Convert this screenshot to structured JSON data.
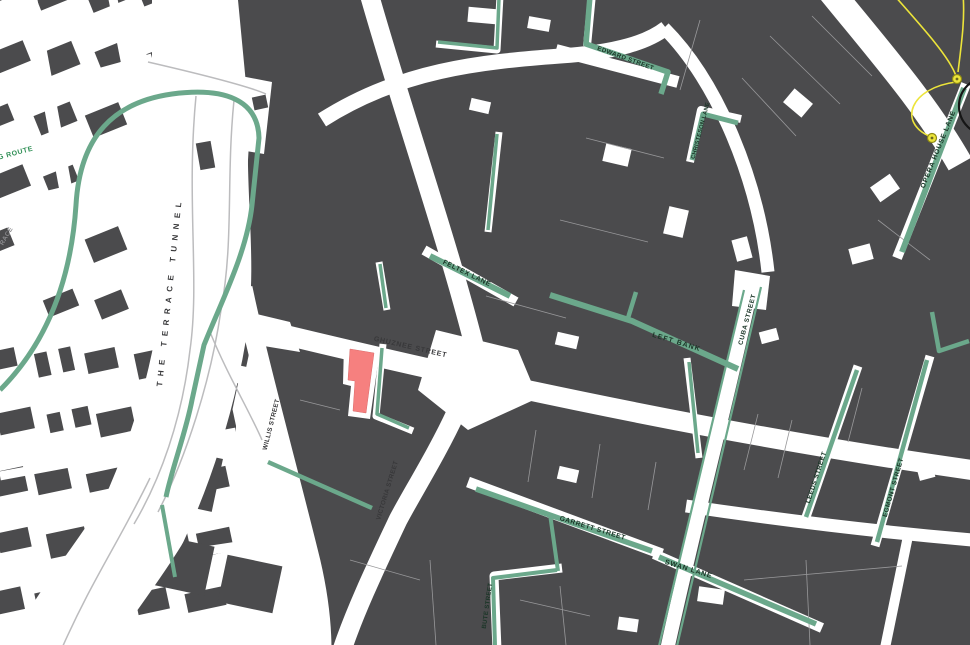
{
  "canvas": {
    "width": 970,
    "height": 645
  },
  "colors": {
    "background": "#ffffff",
    "building": "#4b4b4d",
    "parcel_line": "#98989a",
    "laneway_green": "#6ba88b",
    "label_lane": "#1b3527",
    "label_street": "#38383a",
    "label_route_green": "#2f8f55",
    "label_muted": "#8b8b8e",
    "highlight_red": "#f6807f",
    "annotation_yellow": "#ece43a",
    "annotation_black": "#161616",
    "ramp_gray": "#bcbcbe"
  },
  "labels": [
    {
      "text": "GHUZNEE STREET",
      "x": 410,
      "y": 349,
      "rot": 13,
      "cls": "street",
      "size": 7,
      "ls": 0.8
    },
    {
      "text": "WILLIS STREET",
      "x": 273,
      "y": 425,
      "rot": -76,
      "cls": "street",
      "size": 6.4,
      "ls": 0.3
    },
    {
      "text": "VICTORIA STREET",
      "x": 389,
      "y": 491,
      "rot": -73,
      "cls": "street",
      "size": 6.4,
      "ls": 0.3
    },
    {
      "text": "THE TERRACE TUNNEL",
      "x": 172,
      "y": 292,
      "rot": -84,
      "cls": "street",
      "size": 8,
      "ls": 5.5
    },
    {
      "text": "EDWARD STREET",
      "x": 625,
      "y": 60,
      "rot": 20,
      "cls": "lane",
      "size": 6.3,
      "ls": 0.4
    },
    {
      "text": "CHRISTESON LANE",
      "x": 702,
      "y": 131,
      "rot": -75,
      "cls": "lane",
      "size": 5.8,
      "ls": 0.2
    },
    {
      "text": "OPERA HOUSE LANE",
      "x": 940,
      "y": 150,
      "rot": -68,
      "cls": "lane",
      "size": 6.8,
      "ls": 0.8
    },
    {
      "text": "FELTEX LANE",
      "x": 466,
      "y": 275,
      "rot": 26,
      "cls": "lane",
      "size": 6.8,
      "ls": 0.6
    },
    {
      "text": "LEFT BANK",
      "x": 676,
      "y": 344,
      "rot": 17,
      "cls": "lane",
      "size": 7,
      "ls": 1.2
    },
    {
      "text": "CUBA STREET",
      "x": 749,
      "y": 320,
      "rot": -75,
      "cls": "lane",
      "size": 6.5,
      "ls": 0.6
    },
    {
      "text": "GARRETT STREET",
      "x": 592,
      "y": 530,
      "rot": 17,
      "cls": "lane",
      "size": 6.8,
      "ls": 0.5
    },
    {
      "text": "SWAN LANE",
      "x": 688,
      "y": 571,
      "rot": 17,
      "cls": "lane",
      "size": 7,
      "ls": 0.8
    },
    {
      "text": "LEEDS STREET",
      "x": 818,
      "y": 478,
      "rot": -72,
      "cls": "lane",
      "size": 6.5,
      "ls": 0.4
    },
    {
      "text": "EGMONT STREET",
      "x": 895,
      "y": 488,
      "rot": -74,
      "cls": "lane",
      "size": 6.5,
      "ls": 0.4
    },
    {
      "text": "BUTE STREET",
      "x": 489,
      "y": 606,
      "rot": -82,
      "cls": "lane",
      "size": 6.2,
      "ls": 0.3
    },
    {
      "text": "G ROUTE",
      "x": 16,
      "y": 155,
      "rot": -15,
      "cls": "route",
      "size": 7,
      "ls": 0.6
    },
    {
      "text": "RACE",
      "x": 8,
      "y": 237,
      "rot": -60,
      "cls": "muted",
      "size": 6.5,
      "ls": 0.4
    }
  ],
  "green_segments": [
    {
      "d": "M 0,390 C 55,335 72,265 76,205 C 80,135 115,102 172,94 C 225,87 258,100 259,138 L 252,205 C 247,252 222,300 204,345 L 192,400 C 186,432 172,468 166,497",
      "w": 5
    },
    {
      "d": "M 590,-4 L 586,44 L 668,72 L 661,94",
      "w": 5.5
    },
    {
      "d": "M 738,123 L 703,114 L 692,160",
      "w": 5
    },
    {
      "d": "M 964,88 L 902,252",
      "w": 6
    },
    {
      "d": "M 550,295 L 632,321 L 738,369",
      "w": 6
    },
    {
      "d": "M 628,318 L 636,292",
      "w": 4.5
    },
    {
      "d": "M 744,290 L 659,646",
      "w": 2.2
    },
    {
      "d": "M 761,287 L 677,646",
      "w": 2.2
    },
    {
      "d": "M 476,489 L 652,551",
      "w": 5.5
    },
    {
      "d": "M 550,514 L 558,571",
      "w": 4
    },
    {
      "d": "M 659,557 L 816,624",
      "w": 5.5
    },
    {
      "d": "M 495,646 L 493,578 L 557,570",
      "w": 4
    },
    {
      "d": "M 857,370 L 806,517",
      "w": 4.5
    },
    {
      "d": "M 927,360 L 877,542",
      "w": 4.5
    },
    {
      "d": "M 497,134 L 488,230",
      "w": 3.5
    },
    {
      "d": "M 430,256 L 510,296",
      "w": 6
    },
    {
      "d": "M 380,264 L 386,308",
      "w": 3.5
    },
    {
      "d": "M 382,348 L 377,414 L 409,428",
      "w": 3.5
    },
    {
      "d": "M 268,462 L 372,508",
      "w": 4.5
    },
    {
      "d": "M 162,505 L 175,577",
      "w": 4
    },
    {
      "d": "M 969,341 L 939,351 L 932,312",
      "w": 4.5
    },
    {
      "d": "M 689,362 L 698,453",
      "w": 3.5
    },
    {
      "d": "M 499,-2 L 497,48 L 438,42",
      "w": 3.5
    }
  ],
  "streets_white": [
    {
      "d": "M 248,326 C 420,368 700,432 972,470",
      "w": 20
    },
    {
      "d": "M 368,-10 C 402,110 446,235 474,345 C 479,388 420,478 398,520 C 372,575 354,614 342,650",
      "w": 19
    },
    {
      "d": "M 243,288 C 258,360 291,480 311,562 C 318,592 322,622 322,650",
      "w": 19
    },
    {
      "d": "M 322,120 C 400,70 480,62 560,56 C 618,52 648,42 666,28",
      "w": 15
    },
    {
      "d": "M 556,50 L 678,82",
      "w": 12
    },
    {
      "d": "M 664,28 C 718,82 758,180 768,272",
      "w": 13
    },
    {
      "d": "M 828,-12 C 880,52 926,104 960,164",
      "w": 26
    },
    {
      "d": "M 753,280 C 730,390 700,500 667,650",
      "w": 14
    },
    {
      "d": "M 468,482 L 662,554",
      "w": 11
    },
    {
      "d": "M 654,554 L 822,628",
      "w": 10
    },
    {
      "d": "M 686,506 C 780,520 880,532 972,540",
      "w": 13
    },
    {
      "d": "M 858,366 L 805,520",
      "w": 9
    },
    {
      "d": "M 930,356 L 875,546",
      "w": 9
    },
    {
      "d": "M 497,650 L 494,576 L 562,568",
      "w": 9
    },
    {
      "d": "M 741,119 L 701,110 L 690,162",
      "w": 8
    },
    {
      "d": "M 592,-6 L 587,46",
      "w": 8
    },
    {
      "d": "M 499,132 L 488,232",
      "w": 7
    },
    {
      "d": "M 424,250 L 516,302",
      "w": 10
    },
    {
      "d": "M 379,262 L 387,310",
      "w": 7
    },
    {
      "d": "M 383,344 L 376,416 L 413,431",
      "w": 7
    },
    {
      "d": "M 687,358 L 699,458",
      "w": 7
    },
    {
      "d": "M 500,-4 L 497,50 L 436,44",
      "w": 7
    },
    {
      "d": "M 966,84 L 897,258",
      "w": 10
    },
    {
      "d": "M 908,536 L 885,648",
      "w": 10
    }
  ],
  "junction_polys": [
    "436,330 518,350 538,398 468,430 418,390",
    "240,310 290,322 300,352 252,344",
    "735,270 770,276 766,310 732,306",
    "138,56 272,82 264,154 146,134"
  ],
  "left_bands": [
    {
      "d": "M 30,-5 L 88,310",
      "w": 13
    },
    {
      "d": "M 0,100 L 152,58",
      "w": 9
    },
    {
      "d": "M 0,206 L 84,186",
      "w": 8
    },
    {
      "d": "M 112,-6 L 143,152",
      "w": 9
    },
    {
      "d": "M 50,340 L 118,648",
      "w": 12
    },
    {
      "d": "M 0,476 L 236,432",
      "w": 9
    },
    {
      "d": "M 0,582 L 238,546",
      "w": 9
    }
  ],
  "corridor": {
    "d": "M 206,92 C 196,180 214,252 202,330 C 190,402 168,468 143,522 C 116,566 82,606 58,650",
    "w": 90
  },
  "ramps": [
    {
      "d": "M 196,96 C 186,200 200,280 190,350 C 182,420 160,480 134,524"
    },
    {
      "d": "M 234,100 C 226,180 234,240 221,310 C 211,380 186,458 158,512"
    },
    {
      "d": "M 150,478 C 120,540 92,580 62,648"
    },
    {
      "d": "M 148,62 C 200,74 248,86 266,94"
    },
    {
      "d": "M 210,332 C 228,376 248,408 262,440"
    }
  ],
  "mega_block": "238,0 970,0 970,645 330,645 314,556 240,296 250,126",
  "pre_buildings": [
    {
      "x": 200,
      "y": 312,
      "w": 52,
      "h": 50,
      "rot": 12
    },
    {
      "x": 188,
      "y": 378,
      "w": 46,
      "h": 44,
      "rot": 12
    },
    {
      "x": 156,
      "y": 452,
      "w": 62,
      "h": 54,
      "rot": 12
    },
    {
      "x": 150,
      "y": 540,
      "w": 60,
      "h": 50,
      "rot": 12
    },
    {
      "x": 222,
      "y": 560,
      "w": 56,
      "h": 48,
      "rot": 12
    }
  ],
  "corridor_buildings": [
    {
      "x": 198,
      "y": 142,
      "w": 15,
      "h": 27,
      "rot": -10
    },
    {
      "x": 253,
      "y": 96,
      "w": 14,
      "h": 13,
      "rot": -12
    }
  ],
  "notches": [
    {
      "x": 604,
      "y": 146,
      "w": 26,
      "h": 18,
      "rot": 13
    },
    {
      "x": 666,
      "y": 208,
      "w": 20,
      "h": 28,
      "rot": 13
    },
    {
      "x": 556,
      "y": 334,
      "w": 22,
      "h": 13,
      "rot": 13
    },
    {
      "x": 786,
      "y": 94,
      "w": 24,
      "h": 18,
      "rot": 40
    },
    {
      "x": 850,
      "y": 246,
      "w": 22,
      "h": 16,
      "rot": -15
    },
    {
      "x": 698,
      "y": 588,
      "w": 26,
      "h": 15,
      "rot": 8
    },
    {
      "x": 558,
      "y": 468,
      "w": 20,
      "h": 13,
      "rot": 13
    },
    {
      "x": 876,
      "y": 176,
      "w": 18,
      "h": 24,
      "rot": 55
    },
    {
      "x": 734,
      "y": 238,
      "w": 16,
      "h": 22,
      "rot": -15
    },
    {
      "x": 918,
      "y": 466,
      "w": 16,
      "h": 13,
      "rot": -15
    },
    {
      "x": 618,
      "y": 618,
      "w": 20,
      "h": 13,
      "rot": 8
    },
    {
      "x": 468,
      "y": 8,
      "w": 28,
      "h": 15,
      "rot": 5
    },
    {
      "x": 528,
      "y": 18,
      "w": 22,
      "h": 12,
      "rot": 10
    },
    {
      "x": 760,
      "y": 330,
      "w": 18,
      "h": 12,
      "rot": -15
    },
    {
      "x": 470,
      "y": 100,
      "w": 20,
      "h": 12,
      "rot": 13
    }
  ],
  "parcel_lines": [
    "M 770,36 L 840,104",
    "M 812,16 L 872,76",
    "M 742,78 L 796,136",
    "M 700,20 L 680,90",
    "M 744,470 L 758,414",
    "M 778,478 L 792,420",
    "M 848,442 L 862,388",
    "M 910,420 L 924,372",
    "M 536,430 L 528,482",
    "M 600,444 L 592,498",
    "M 656,462 L 648,510",
    "M 486,296 L 566,318",
    "M 560,220 L 648,242",
    "M 586,138 L 664,158",
    "M 560,586 L 566,645",
    "M 744,580 L 902,566",
    "M 806,560 L 810,645",
    "M 878,220 L 930,260",
    "M 350,560 L 420,580",
    "M 300,400 L 340,410",
    "M 430,560 L 436,645",
    "M 520,600 L 590,616"
  ],
  "highlight_building": {
    "margin": "344,344 380,349 370,419 348,416 351,386 343,384",
    "shape": "350,349 374,353 366,413 353,411 355,381 348,380"
  },
  "annotations": {
    "arcs": [
      "M 893,-6 C 925,30 950,58 956,76",
      "M 956,82 C 910,88 898,122 929,136",
      "M 958,72 C 962,40 965,18 963,-6"
    ],
    "nodes": [
      {
        "x": 957,
        "y": 79,
        "r": 4.5
      },
      {
        "x": 932,
        "y": 138,
        "r": 4.5
      }
    ],
    "circle": {
      "x": 988,
      "y": 106,
      "r": 29
    }
  }
}
